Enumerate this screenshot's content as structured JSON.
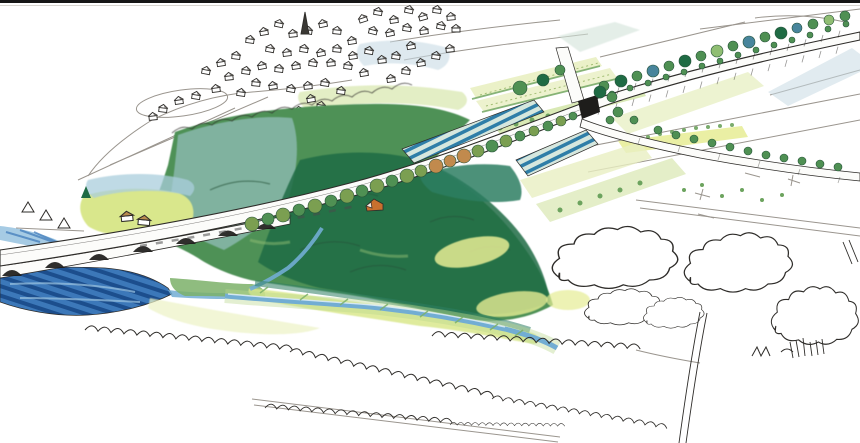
{
  "image": {
    "width": 860,
    "height": 443
  },
  "scene": {
    "type": "hand-drawn landscape architecture concept sketch",
    "medium": "ink pen with watercolor and colored pencil",
    "subject": "aerial perspective of a new viaduct road crossing a wooded river valley",
    "labels": {
      "border": "dark strip along top edge of scanned sketch",
      "village": "hillside village of small sketched houses",
      "church_spire": "church spire rising from village centre",
      "woodland": "large green wooded valley slope",
      "viaduct": "arched viaduct carrying road over river",
      "main_road": "road over viaduct continuing as tree-lined avenue to upper right",
      "underpass": "dark underpass portal beneath road embankment",
      "crossing_road": "secondary road passing under embankment toward lower right fields",
      "tree_avenue": "avenue trees flanking embanked road",
      "roadside_trees": "row of round trees along downhill side of viaduct road",
      "river": "dark blue river flowing beneath viaduct arches",
      "stream": "pale blue stream meandering through valley meadow",
      "meadows": "yellow-green water meadows beside river and stream",
      "striped_fields": "blue-green striped crop fields beside road",
      "crop_fields": "terraced crop strips between village and junction",
      "farmhouses": "two small tan-roofed farm buildings in meadow",
      "forest_house": "small orange-roofed house at woodland edge",
      "hedgerows": "uncoloured sketched hedgerows across foreground",
      "sketch_trees": "uncoloured pen-drawn tree clusters lower right",
      "country_roads": "pencil field roads and boundary lines on right"
    }
  },
  "palette": {
    "paper": "#ffffff",
    "border": "#161616",
    "ink": "#2e2c29",
    "pencil": "#9a958e",
    "forest_base": "#4e9156",
    "forest_dark": "#1f6b44",
    "forest_teal": "#2d7e62",
    "forest_light": "#90be73",
    "canopy_ink": "#27543a",
    "hill_blue": "#a9cddc",
    "backdrop_blue": "#c8dbe4",
    "backdrop_green": "#d7e7ac",
    "distant_teal": "#d2e3d9",
    "meadow": "#d9e78c",
    "meadow_pale": "#ecf2c5",
    "glade": "#e6ec94",
    "river_deep": "#1c4e8d",
    "river_mid": "#3c78b9",
    "river_light": "#9cc5e1",
    "stream": "#72add3",
    "bank_green": "#7bb069",
    "stripe_teal": "#2f7ea8",
    "stripe_bg": "#d6e7de",
    "crop_light": "#e9efc2",
    "crop_row": "#a2be73",
    "hedge_green": "#6ca35e",
    "road_white": "#fcfcfa",
    "shadow": "#1e1d1b",
    "tree_olive": "#7b9f51",
    "tree_green": "#4f9053",
    "tree_orange": "#c18a4d",
    "tree_bluegreen": "#48859c",
    "roof_tan": "#b98b4f",
    "roof_orange": "#c8702e"
  }
}
